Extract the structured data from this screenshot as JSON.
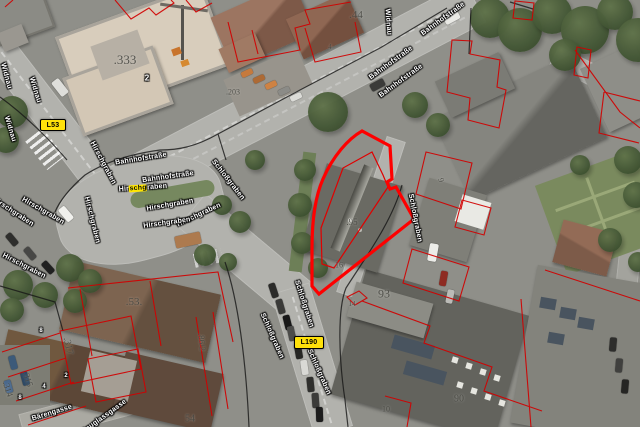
{
  "view": {
    "type": "aerial-orthophoto-cadastre",
    "colors": {
      "selected_parcel_outline": "#fe0000",
      "parcel_boundary_red": "#d10000",
      "cadastral_line_black": "#161616",
      "route_badge_yellow": "#ffe10a",
      "search_highlight_yellow": "#ffe600"
    }
  },
  "route_badges": [
    {
      "text": "L53",
      "x": 40,
      "y": 119,
      "w": 24,
      "h": 10
    },
    {
      "text": "L190",
      "x": 294,
      "y": 336,
      "w": 28,
      "h": 11
    }
  ],
  "search_highlight": {
    "pre": "Hir",
    "mark": "schg",
    "post": "raben",
    "x": 143,
    "y": 188,
    "rot": -4
  },
  "street_labels": [
    {
      "text": "Widnau",
      "x": 6,
      "y": 76,
      "rot": 75
    },
    {
      "text": "Widnau",
      "x": 35,
      "y": 90,
      "rot": 73
    },
    {
      "text": "Widnau",
      "x": 10,
      "y": 129,
      "rot": 73
    },
    {
      "text": "Widnau",
      "x": 388,
      "y": 22,
      "rot": 86
    },
    {
      "text": "Bahnhofstraße",
      "x": 443,
      "y": 19,
      "rot": -36
    },
    {
      "text": "Bahnhofstraße",
      "x": 391,
      "y": 63,
      "rot": -36
    },
    {
      "text": "Bahnhofstraße",
      "x": 401,
      "y": 81,
      "rot": -36
    },
    {
      "text": "Bahnhofstraße",
      "x": 141,
      "y": 159,
      "rot": -9
    },
    {
      "text": "Bahnhofstraße",
      "x": 168,
      "y": 177,
      "rot": -8
    },
    {
      "text": "Hirschgraben",
      "x": 103,
      "y": 163,
      "rot": 62
    },
    {
      "text": "Hirschgraben",
      "x": 13,
      "y": 212,
      "rot": 33
    },
    {
      "text": "Hirschgraben",
      "x": 43,
      "y": 211,
      "rot": 30
    },
    {
      "text": "Hirschgraben",
      "x": 92,
      "y": 220,
      "rot": 76
    },
    {
      "text": "Hirschgraben",
      "x": 170,
      "y": 205,
      "rot": -10
    },
    {
      "text": "Hirschgraben",
      "x": 199,
      "y": 215,
      "rot": -25
    },
    {
      "text": "Hirschgraben",
      "x": 167,
      "y": 223,
      "rot": -8
    },
    {
      "text": "Hirschgraben",
      "x": 24,
      "y": 266,
      "rot": 27
    },
    {
      "text": "Schloßgraben",
      "x": 228,
      "y": 180,
      "rot": 52
    },
    {
      "text": "Schloßgraben",
      "x": 304,
      "y": 304,
      "rot": 72
    },
    {
      "text": "Schloßgraben",
      "x": 272,
      "y": 336,
      "rot": 66
    },
    {
      "text": "Schloßgraben",
      "x": 319,
      "y": 372,
      "rot": 66
    },
    {
      "text": "Schloßgraben",
      "x": 415,
      "y": 218,
      "rot": 79
    },
    {
      "text": "Bärengasse",
      "x": 52,
      "y": 413,
      "rot": -17
    },
    {
      "text": "Douglassgasse",
      "x": 104,
      "y": 417,
      "rot": -36
    }
  ],
  "parcel_labels": [
    {
      "text": ".333",
      "x": 125,
      "y": 60,
      "s": 13,
      "rot": 0
    },
    {
      "text": ".44",
      "x": 356,
      "y": 15,
      "s": 11,
      "rot": 0
    },
    {
      "text": "4",
      "x": 330,
      "y": 47,
      "s": 7,
      "rot": 0
    },
    {
      "text": ".203",
      "x": 233,
      "y": 92,
      "s": 8,
      "rot": 0
    },
    {
      "text": "9",
      "x": 441,
      "y": 180,
      "s": 8,
      "rot": 75
    },
    {
      "text": ".95",
      "x": 352,
      "y": 222,
      "s": 9,
      "rot": 0
    },
    {
      "text": ".16",
      "x": 338,
      "y": 265,
      "s": 8,
      "rot": 0
    },
    {
      "text": "93",
      "x": 384,
      "y": 294,
      "s": 12,
      "rot": 0
    },
    {
      "text": ".53.",
      "x": 134,
      "y": 302,
      "s": 11,
      "rot": 0
    },
    {
      "text": ".317",
      "x": 68,
      "y": 346,
      "s": 10,
      "rot": 78
    },
    {
      "text": ".315",
      "x": 28,
      "y": 379,
      "s": 9,
      "rot": 72
    },
    {
      "text": ".314",
      "x": 8,
      "y": 389,
      "s": 9,
      "rot": 72
    },
    {
      "text": ".86/2",
      "x": 202,
      "y": 342,
      "s": 9,
      "rot": 85
    },
    {
      "text": "54",
      "x": 190,
      "y": 419,
      "s": 10,
      "rot": 0
    },
    {
      "text": "90",
      "x": 459,
      "y": 399,
      "s": 10,
      "rot": 0
    },
    {
      "text": "14",
      "x": 352,
      "y": 304,
      "s": 7,
      "rot": 0
    },
    {
      "text": "10",
      "x": 386,
      "y": 409,
      "s": 8,
      "rot": 0
    }
  ],
  "marker_labels": [
    {
      "text": "2",
      "x": 147,
      "y": 78,
      "s": 8
    },
    {
      "text": "8",
      "x": 41,
      "y": 331,
      "s": 6
    },
    {
      "text": "2",
      "x": 66,
      "y": 376,
      "s": 6
    },
    {
      "text": "4",
      "x": 44,
      "y": 387,
      "s": 6
    },
    {
      "text": "8",
      "x": 20,
      "y": 398,
      "s": 6
    }
  ]
}
